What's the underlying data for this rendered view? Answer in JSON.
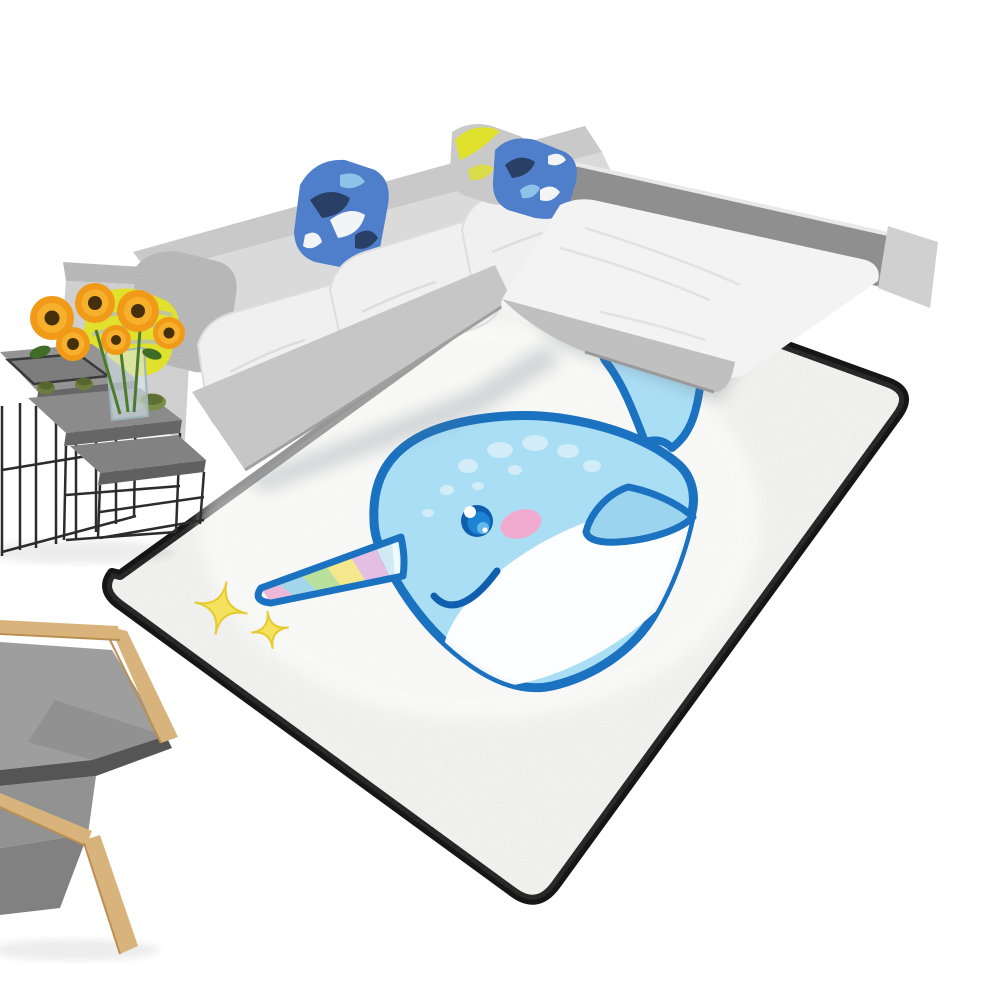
{
  "meta": {
    "alt": "Product staging photo: rectangular white area rug with black trim printed with a cute cartoon narwhal and yellow sparkles, shown at an angle on a white floor beside a light gray L-shaped sectional sofa with decorative pillows, a set of black metal nesting side tables holding a tray, green cups and a glass vase of sunflowers, and a partially visible gray armchair with light wood frame"
  },
  "colors": {
    "background": "#ffffff",
    "rug_field": "#f6f6f4",
    "rug_border": "#161616",
    "rug_shade": "#9aa0a6",
    "narwhal_body": "#a9def5",
    "narwhal_outline": "#1a72c0",
    "narwhal_belly": "#ffffff",
    "narwhal_spot": "#d3edf8",
    "narwhal_cheek": "#f2abd0",
    "eye_ring": "#0f5fae",
    "eye_iris": "#1e83d4",
    "eye_glint": "#6cc0f0",
    "smile_stroke": "#0f5fae",
    "horn_stripes": [
      "#cfe9f5",
      "#e3bfe3",
      "#f4e78c",
      "#b9e09c",
      "#a2d6ec",
      "#ecb8d8"
    ],
    "sparkle_fill": "#f4e15e",
    "sparkle_edge": "#e6cb30",
    "sofa_back": "#dadada",
    "sofa_back_top": "#c9c9c9",
    "sofa_arm": "#cfcfcf",
    "sofa_arm_top": "#b8b8b8",
    "sofa_seat": "#f0f0f0",
    "sofa_base": "#c6c6c6",
    "chaise_back": "#8f8f8f",
    "chaise_cap": "#d0d0d0",
    "chaise_seat": "#f3f3f3",
    "chaise_base": "#c0c0c0",
    "pillow_yellow": "#dfe12d",
    "pillow_yellow_stripe": "#b9c0b0",
    "pillow_gray": "#b7b7b7",
    "pillow_gray_light": "#c9c9c9",
    "pillow_blue": "#4f7fca",
    "pillow_navy": "#2a3f66",
    "pillow_white": "#f2f4f6",
    "pillow_sky": "#8fc2e8",
    "table_frame": "#2c2c2c",
    "table_top1": "#949494",
    "table_top2": "#8b8b8b",
    "table_top3": "#828282",
    "table_edge": "#666666",
    "tray": "#7d7d7d",
    "cup_green": "#6d7c3e",
    "bowl_green": "#7c8d45",
    "flower_petal": "#f09a18",
    "flower_petal_light": "#f7b02c",
    "flower_center": "#46300c",
    "leaf_green": "#3f6d26",
    "stem_green": "#4e7a2c",
    "vase_glass": "#d7e6ec",
    "chair_wood": "#d8b47c",
    "chair_cushion": "#9e9e9e",
    "chair_cushion_dark": "#555555",
    "shadow": "#70767c"
  },
  "scene": {
    "rug": {
      "description": "rectangular kids rug in perspective, white speckled field, black edge trim, cartoon narwhal print",
      "motif": "baby narwhal with striped unicorn-like tusk, pink cheek, white belly and two yellow sparkle stars"
    },
    "sofa": {
      "description": "light gray L-shaped sectional with chaise, five decorative pillows",
      "pillows": [
        "yellow striped pillow",
        "gray textured pillow",
        "blue camouflage pillow",
        "gray pillow with yellow splash",
        "blue camouflage pillow"
      ]
    },
    "tables": {
      "description": "three black wireframe nesting side tables with serving tray, green cups, green bowl and glass vase of sunflowers"
    },
    "chair": {
      "description": "gray upholstered armchair with bent light-wood frame, partially visible at lower left"
    }
  }
}
